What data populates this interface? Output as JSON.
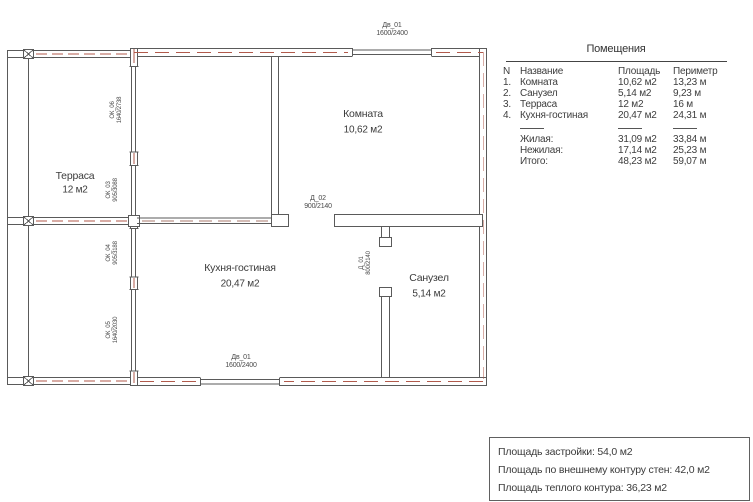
{
  "plan": {
    "rooms": [
      {
        "name": "Терраса",
        "area": "12 м2"
      },
      {
        "name": "Комната",
        "area": "10,62 м2"
      },
      {
        "name": "Кухня-гостиная",
        "area": "20,47 м2"
      },
      {
        "name": "Санузел",
        "area": "5,14 м2"
      }
    ],
    "openings": {
      "top_door": {
        "id": "Дв_01",
        "size": "1600/2400"
      },
      "bottom_door": {
        "id": "Дв_01",
        "size": "1600/2400"
      },
      "room_door": {
        "id": "Д_02",
        "size": "900/2140"
      },
      "bath_door": {
        "id": "Д_01",
        "size": "800/2140"
      },
      "window_1": {
        "id": "ОК_06",
        "size": "1640/2738"
      },
      "window_2": {
        "id": "ОК_03",
        "size": "905/3088"
      },
      "window_3": {
        "id": "ОК_04",
        "size": "905/3188"
      },
      "window_4": {
        "id": "ОК_05",
        "size": "1640/2030"
      }
    },
    "colors": {
      "wall_line": "#4f4f4f",
      "insulation_dash": "#b15a4b"
    }
  },
  "table": {
    "title": "Помещения",
    "headers": {
      "n": "N",
      "name": "Название",
      "area": "Площадь",
      "perimeter": "Периметр"
    },
    "rows": [
      {
        "n": "1.",
        "name": "Комната",
        "area": "10,62 м2",
        "perimeter": "13,23 м"
      },
      {
        "n": "2.",
        "name": "Санузел",
        "area": "5,14 м2",
        "perimeter": "9,23 м"
      },
      {
        "n": "3.",
        "name": "Терраса",
        "area": "12 м2",
        "perimeter": "16 м"
      },
      {
        "n": "4.",
        "name": "Кухня-гостиная",
        "area": "20,47 м2",
        "perimeter": "24,31 м"
      }
    ],
    "totals": [
      {
        "name": "Жилая:",
        "area": "31,09 м2",
        "perimeter": "33,84 м"
      },
      {
        "name": "Нежилая:",
        "area": "17,14 м2",
        "perimeter": "25,23 м"
      },
      {
        "name": "Итого:",
        "area": "48,23 м2",
        "perimeter": "59,07 м"
      }
    ]
  },
  "summary": {
    "lines": [
      "Площадь застройки: 54,0 м2",
      "Площадь по внешнему контуру стен: 42,0 м2",
      "Площадь теплого контура: 36,23 м2"
    ]
  }
}
